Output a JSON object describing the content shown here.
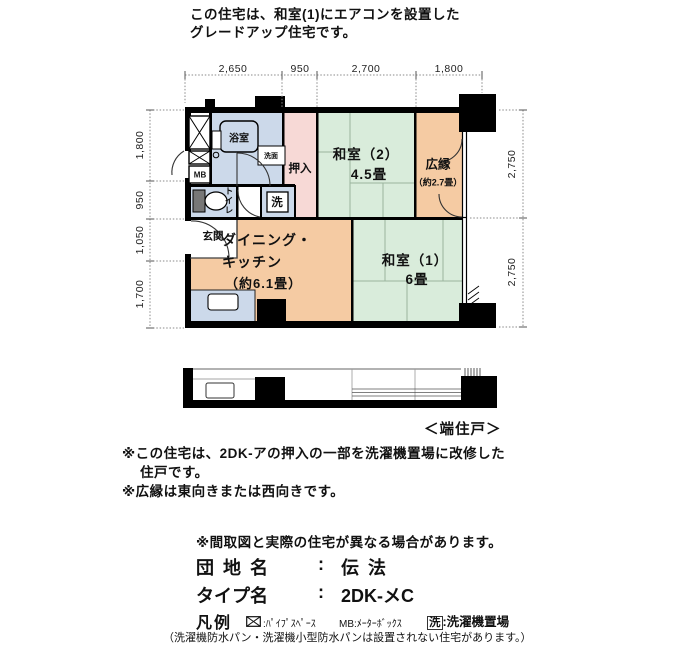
{
  "header": {
    "line1": "この住宅は、和室(1)にエアコンを設置した",
    "line2": "グレードアップ住宅です。"
  },
  "plan": {
    "dims_top": [
      "2,650",
      "950",
      "2,700",
      "1,800"
    ],
    "dims_left": [
      "1,800",
      "950",
      "1,050",
      "1,700"
    ],
    "dims_right": [
      "2,750",
      "2,750"
    ],
    "rooms": {
      "bath": "浴室",
      "washstand": "洗面",
      "meter_box": "MB",
      "toilet": "トイレ",
      "closet": "押入",
      "washer": "洗",
      "entrance": "玄関",
      "jroom2_name": "和室（2）",
      "jroom2_size": "4.5畳",
      "veranda_name": "広縁",
      "veranda_size": "（約2.7畳）",
      "dk_name1": "ダイニング・",
      "dk_name2": "キッチン",
      "dk_size": "（約6.1畳）",
      "jroom1_name": "和室（1）",
      "jroom1_size": "6畳"
    },
    "unit_tag": "＜端住戸＞"
  },
  "notes": {
    "note1_line1": "※この住宅は、2DK-アの押入の一部を洗濯機置場に改修した",
    "note1_line2": "住戸です。",
    "note2": "※広縁は東向きまたは西向きです。",
    "disclaimer": "※間取図と実際の住宅が異なる場合があります。"
  },
  "info": {
    "estate_label": "団 地 名",
    "estate_sep": ":",
    "estate_value": "伝 法",
    "type_label": "タイプ名",
    "type_sep": ":",
    "type_value": "2DK-メC"
  },
  "legend": {
    "title": "凡例",
    "ps_sep": ":",
    "ps_label": "ﾊﾟｲﾌﾟｽﾍﾟｰｽ",
    "mb_key": "MB",
    "mb_sep": ":",
    "mb_label": "ﾒｰﾀｰﾎﾞｯｸｽ",
    "washer_key": "洗",
    "washer_sep": ":",
    "washer_label": "洗濯機置場",
    "footnote": "（洗濯機防水パン・洗濯機小型防水パンは設置されない住宅があります。）"
  },
  "colors": {
    "water_blue": "#ccd9ea",
    "tatami_green": "#d9ecdb",
    "closet_pink": "#f7d9d6",
    "wood_orange": "#f5cba3",
    "wall_black": "#000000",
    "tatami_line": "#9bb49e",
    "dim_gray": "#8a8a8a"
  }
}
